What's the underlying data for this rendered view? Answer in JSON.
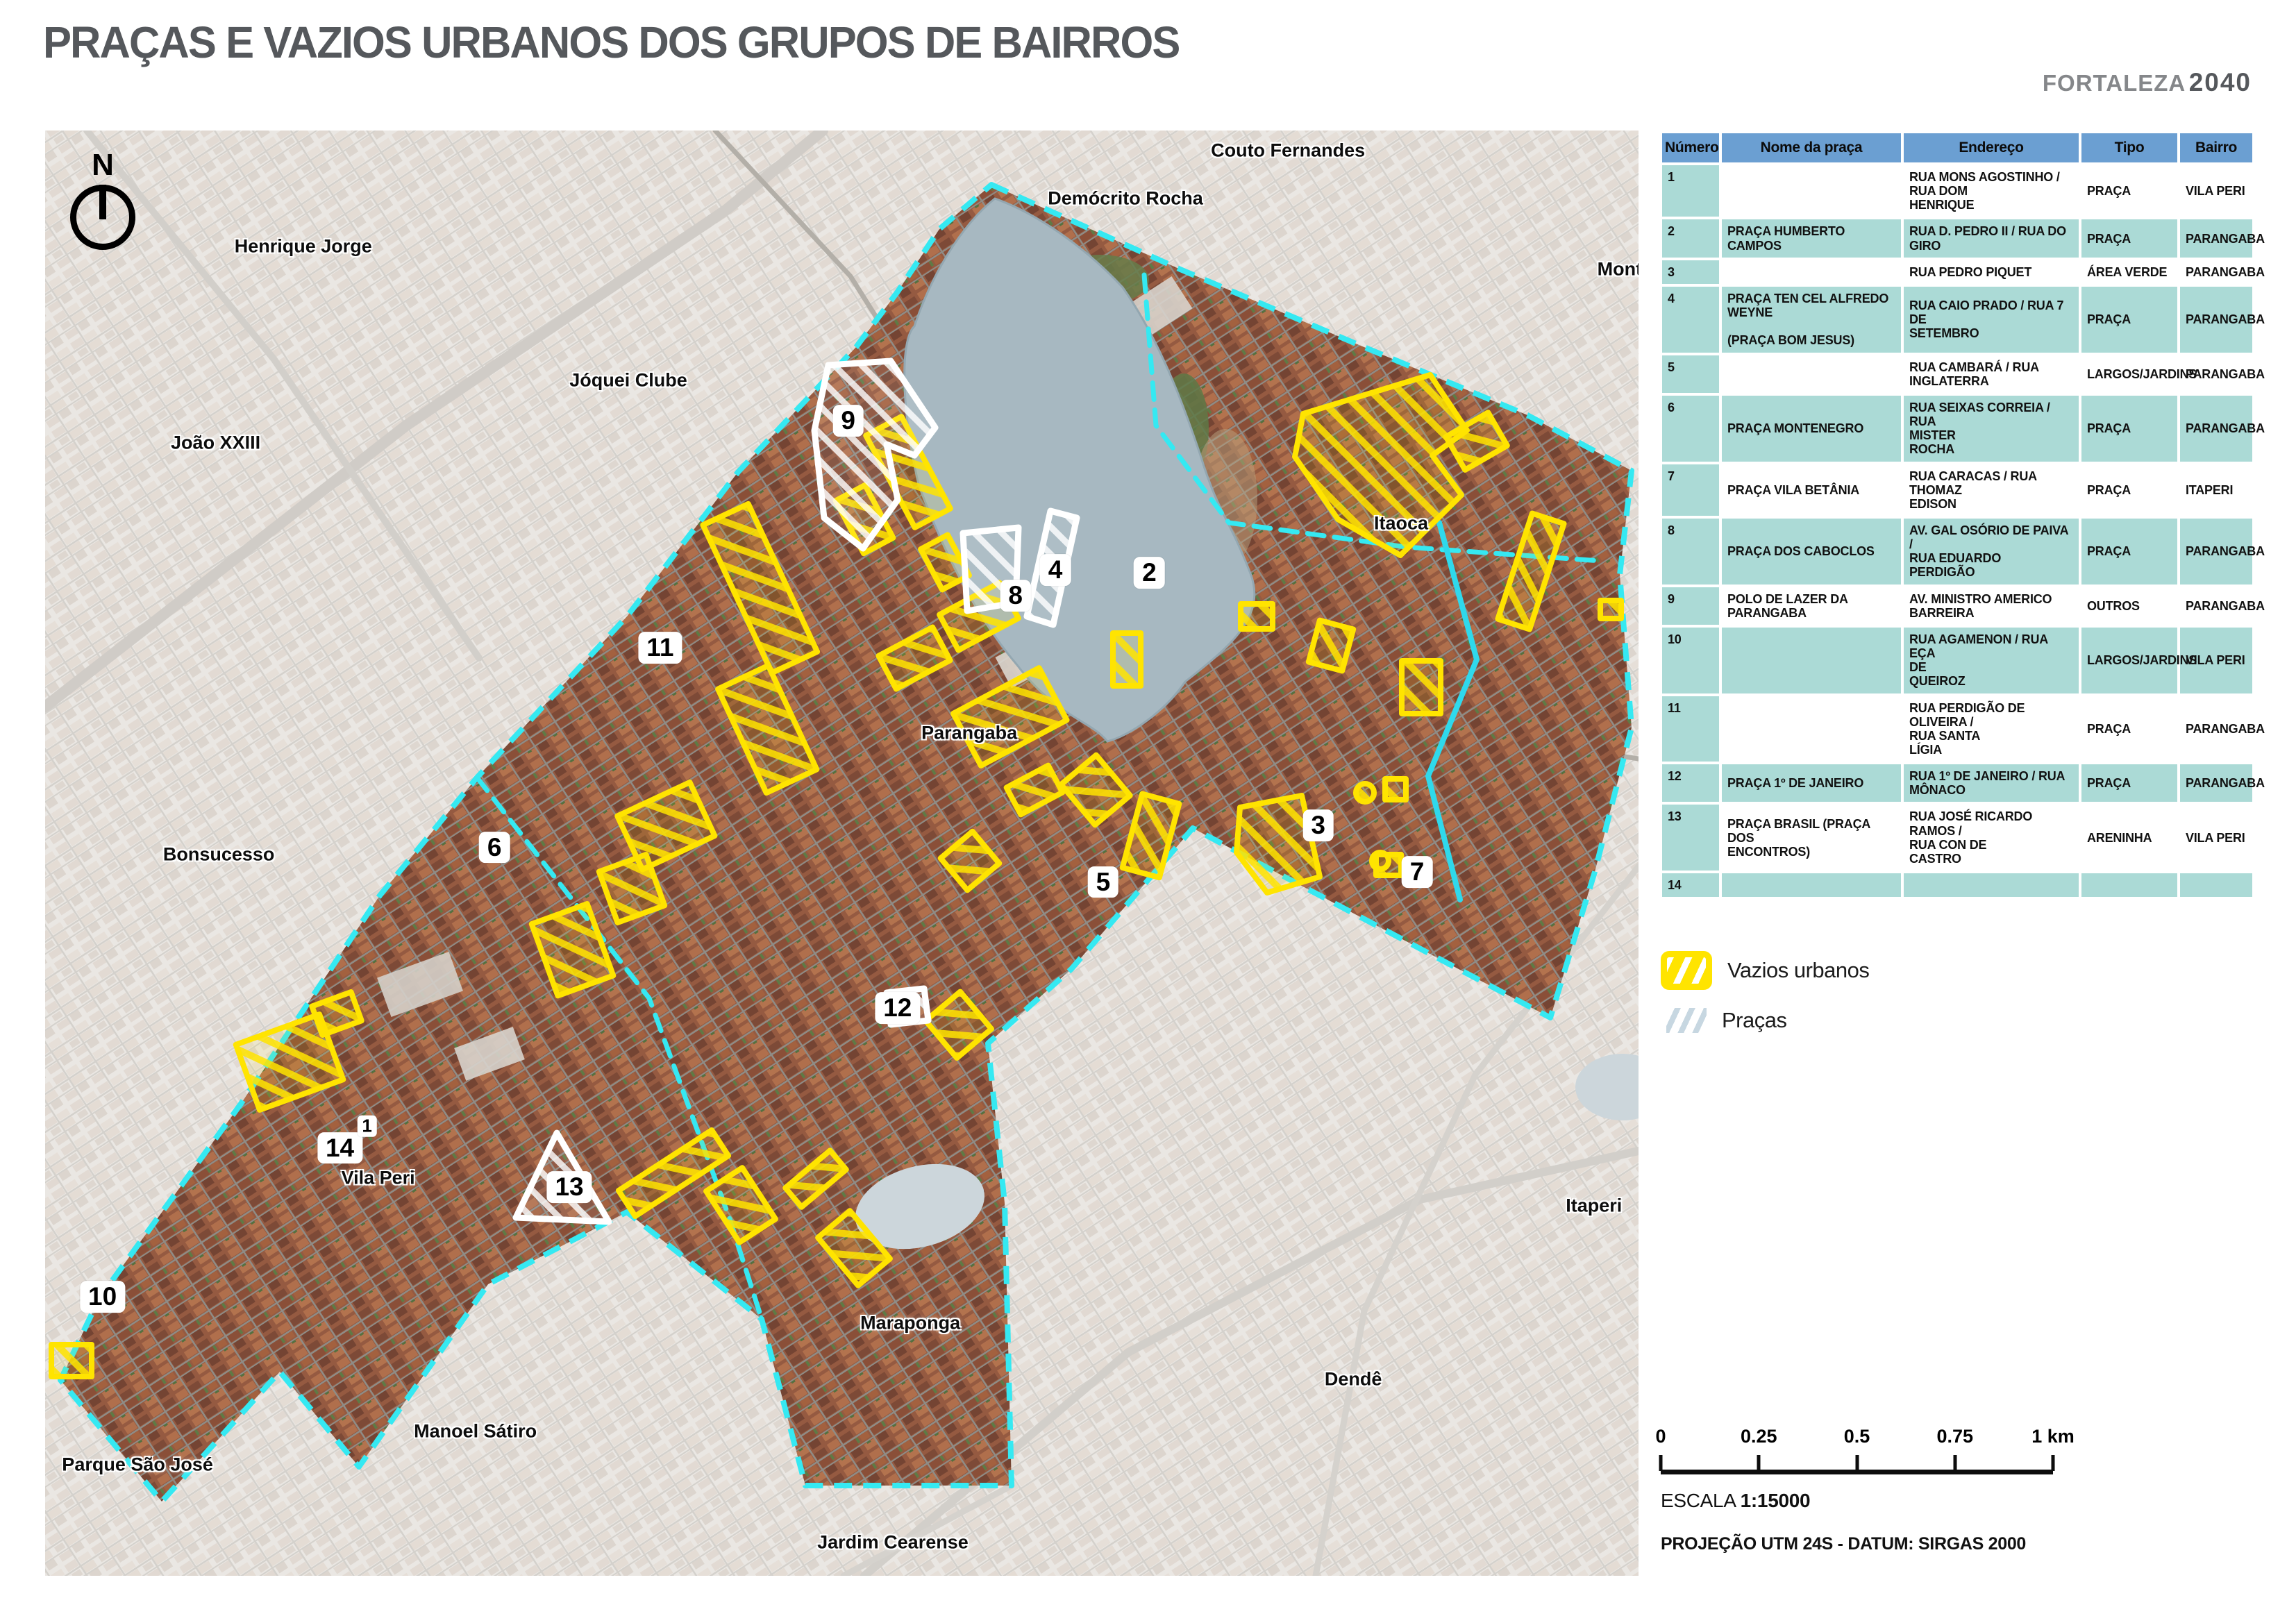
{
  "title": "PRAÇAS E VAZIOS URBANOS DOS GRUPOS DE BAIRROS",
  "brand": {
    "name": "FORTALEZA",
    "year": "2040"
  },
  "map": {
    "north_label": "N",
    "area_labels": [
      {
        "text": "Couto Fernandes",
        "x": 78.0,
        "y": 1.4
      },
      {
        "text": "Demócrito Rocha",
        "x": 67.8,
        "y": 4.7
      },
      {
        "text": "Henrique Jorge",
        "x": 16.2,
        "y": 8.0
      },
      {
        "text": "Jóquei Clube",
        "x": 36.6,
        "y": 17.3
      },
      {
        "text": "João XXIII",
        "x": 10.7,
        "y": 21.6
      },
      {
        "text": "Bonsucesso",
        "x": 10.9,
        "y": 50.1
      },
      {
        "text": "Itaoca",
        "x": 85.1,
        "y": 27.2
      },
      {
        "text": "Parangaba",
        "x": 58.0,
        "y": 41.7
      },
      {
        "text": "Vila Peri",
        "x": 20.9,
        "y": 72.5
      },
      {
        "text": "Parque São José",
        "x": 5.8,
        "y": 92.3
      },
      {
        "text": "Manoel Sátiro",
        "x": 27.0,
        "y": 90.0
      },
      {
        "text": "Maraponga",
        "x": 54.3,
        "y": 82.5
      },
      {
        "text": "Jardim Cearense",
        "x": 53.2,
        "y": 97.7
      },
      {
        "text": "Dendê",
        "x": 82.1,
        "y": 86.4
      },
      {
        "text": "Itaperi",
        "x": 97.2,
        "y": 74.4
      },
      {
        "text": "Montese",
        "x": 99.8,
        "y": 9.6
      }
    ],
    "markers": [
      {
        "n": "9",
        "x": 50.4,
        "y": 20.1
      },
      {
        "n": "11",
        "x": 38.6,
        "y": 35.8
      },
      {
        "n": "8",
        "x": 60.9,
        "y": 32.2
      },
      {
        "n": "4",
        "x": 63.4,
        "y": 30.4
      },
      {
        "n": "2",
        "x": 69.3,
        "y": 30.6
      },
      {
        "n": "3",
        "x": 79.9,
        "y": 48.1
      },
      {
        "n": "5",
        "x": 66.4,
        "y": 52.0
      },
      {
        "n": "6",
        "x": 28.2,
        "y": 49.6
      },
      {
        "n": "7",
        "x": 86.1,
        "y": 51.3
      },
      {
        "n": "10",
        "x": 3.6,
        "y": 80.7
      },
      {
        "n": "12",
        "x": 53.5,
        "y": 60.7
      },
      {
        "n": "13",
        "x": 32.9,
        "y": 73.1
      },
      {
        "n": "14",
        "x": 18.5,
        "y": 70.4
      },
      {
        "n": "1",
        "x": 20.2,
        "y": 68.9,
        "size": "sm"
      }
    ],
    "colors": {
      "boundary_cyan": "#35e9f2",
      "vazios_yellow": "#ffe400",
      "pracas_white": "#ffffff",
      "lake_blue": "#a7b8c1"
    }
  },
  "table": {
    "headers": [
      "Número",
      "Nome da praça",
      "Endereço",
      "Tipo",
      "Bairro"
    ],
    "rows": [
      [
        "1",
        "",
        "RUA MONS AGOSTINHO / RUA DOM\nHENRIQUE",
        "PRAÇA",
        "VILA PERI"
      ],
      [
        "2",
        "PRAÇA HUMBERTO CAMPOS",
        "RUA D. PEDRO II / RUA DO\nGIRO",
        "PRAÇA",
        "PARANGABA"
      ],
      [
        "3",
        "",
        "RUA PEDRO PIQUET",
        "ÁREA VERDE",
        "PARANGABA"
      ],
      [
        "4",
        "PRAÇA TEN CEL ALFREDO\nWEYNE\n\n(PRAÇA BOM JESUS)",
        "RUA CAIO PRADO / RUA 7 DE\nSETEMBRO",
        "PRAÇA",
        "PARANGABA"
      ],
      [
        "5",
        "",
        "RUA CAMBARÁ / RUA\nINGLATERRA",
        "LARGOS/JARDINS",
        "PARANGABA"
      ],
      [
        "6",
        "PRAÇA MONTENEGRO",
        "RUA SEIXAS CORREIA / RUA\nMISTER\nROCHA",
        "PRAÇA",
        "PARANGABA"
      ],
      [
        "7",
        "PRAÇA VILA BETÂNIA",
        "RUA CARACAS / RUA THOMAZ\nEDISON",
        "PRAÇA",
        "ITAPERI"
      ],
      [
        "8",
        "PRAÇA DOS CABOCLOS",
        "AV. GAL OSÓRIO DE PAIVA /\nRUA EDUARDO\nPERDIGÃO",
        "PRAÇA",
        "PARANGABA"
      ],
      [
        "9",
        "POLO DE LAZER DA\nPARANGABA",
        "AV. MINISTRO AMERICO\nBARREIRA",
        "OUTROS",
        "PARANGABA"
      ],
      [
        "10",
        "",
        "RUA AGAMENON / RUA EÇA\nDE\nQUEIROZ",
        "LARGOS/JARDINS",
        "VILA PERI"
      ],
      [
        "11",
        "",
        "RUA PERDIGÃO DE OLIVEIRA /\nRUA SANTA\nLÍGIA",
        "PRAÇA",
        "PARANGABA"
      ],
      [
        "12",
        "PRAÇA 1º DE JANEIRO",
        "RUA 1º DE JANEIRO / RUA\nMÔNACO",
        "PRAÇA",
        "PARANGABA"
      ],
      [
        "13",
        "PRAÇA BRASIL (PRAÇA DOS\nENCONTROS)",
        "RUA JOSÉ RICARDO RAMOS /\nRUA CON DE\nCASTRO",
        "ARENINHA",
        "VILA PERI"
      ],
      [
        "14",
        "",
        "",
        "",
        ""
      ]
    ]
  },
  "legend": {
    "items": [
      {
        "label": "Vazios urbanos",
        "type": "vazios"
      },
      {
        "label": "Praças",
        "type": "pracas"
      }
    ]
  },
  "scalebar": {
    "ticks": [
      "0",
      "0.25",
      "0.5",
      "0.75",
      "1 km"
    ]
  },
  "footer": {
    "escala_label": "ESCALA ",
    "escala_value": "1:15000",
    "projecao": "PROJEÇÃO UTM 24S - DATUM: SIRGAS 2000"
  }
}
